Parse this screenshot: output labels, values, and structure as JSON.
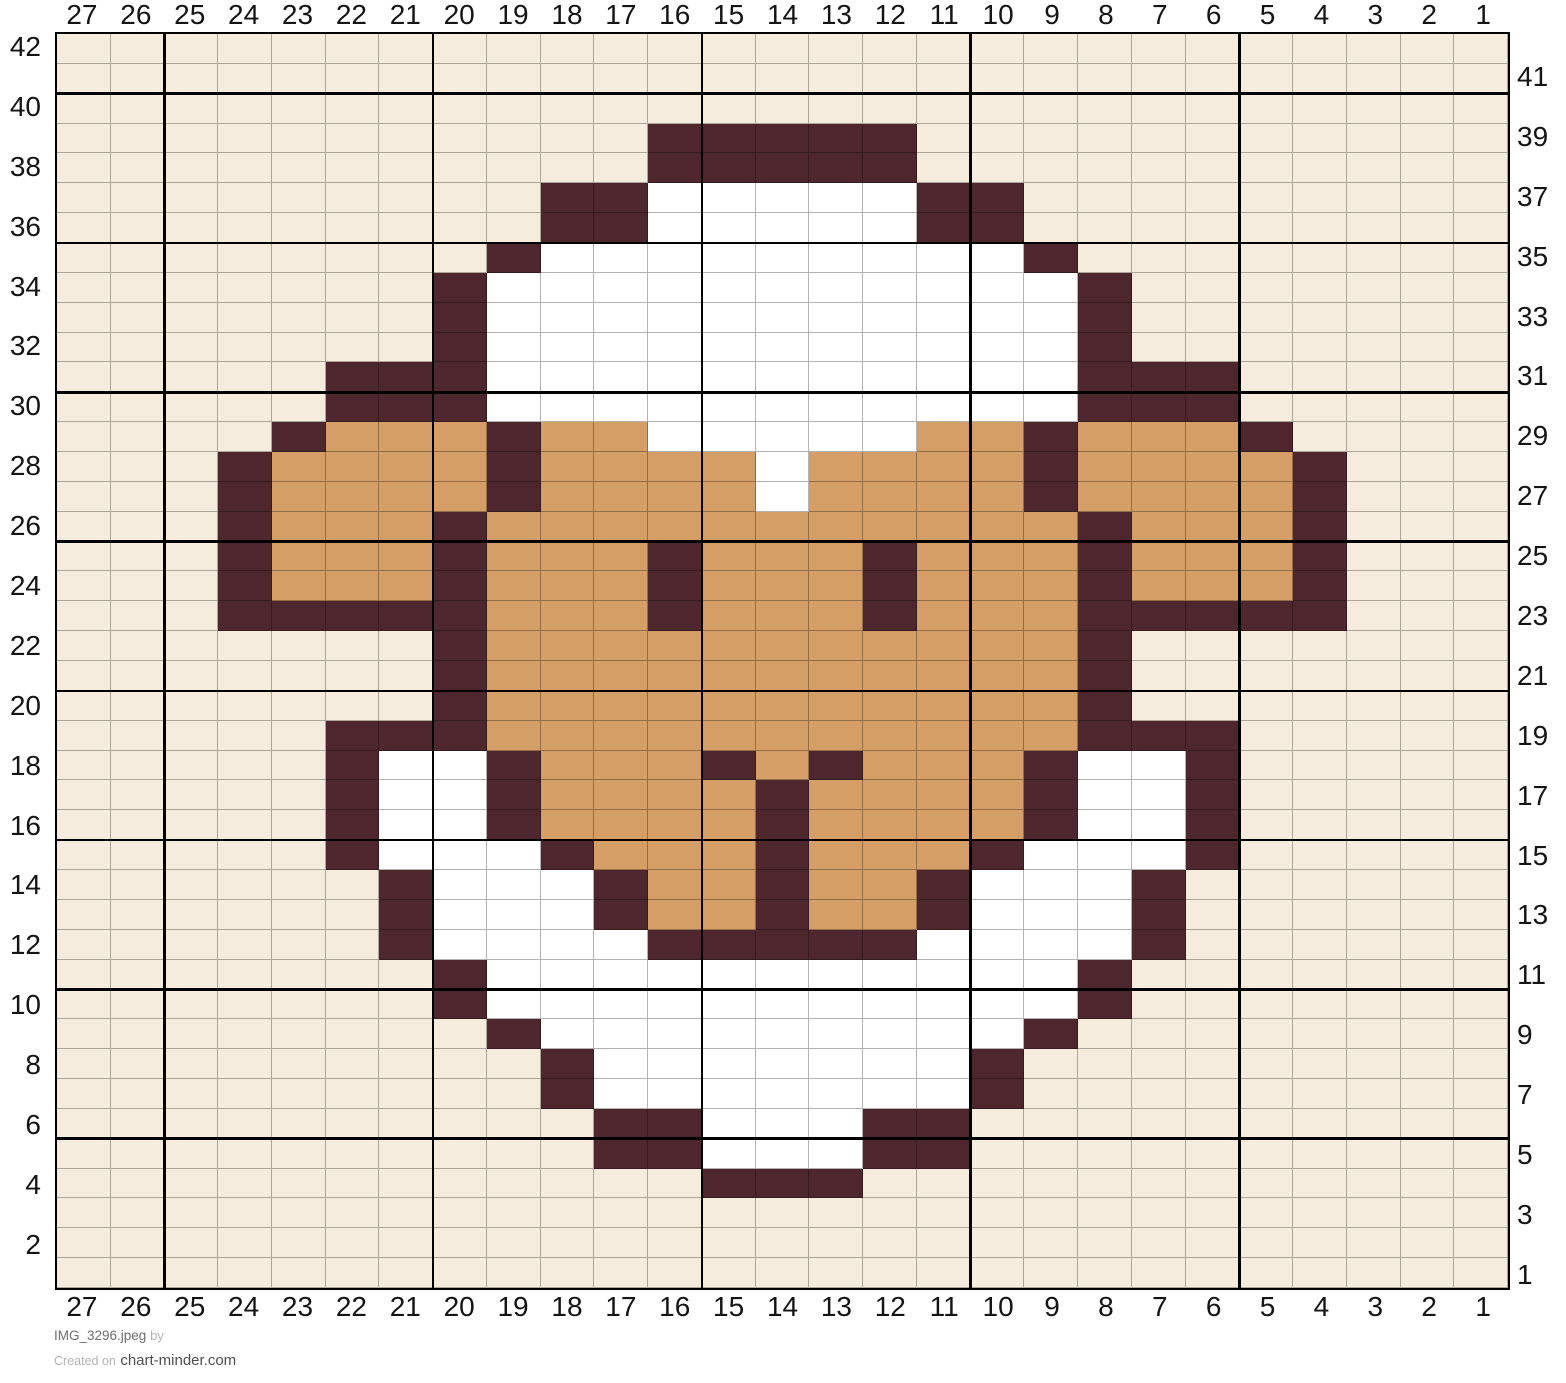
{
  "chart_data": {
    "type": "heatmap",
    "grid_cols": 27,
    "grid_rows": 42,
    "column_labels": [
      "27",
      "26",
      "25",
      "24",
      "23",
      "22",
      "21",
      "20",
      "19",
      "18",
      "17",
      "16",
      "15",
      "14",
      "13",
      "12",
      "11",
      "10",
      "9",
      "8",
      "7",
      "6",
      "5",
      "4",
      "3",
      "2",
      "1"
    ],
    "left_row_labels": [
      "42",
      "40",
      "38",
      "36",
      "34",
      "32",
      "30",
      "28",
      "26",
      "24",
      "22",
      "20",
      "18",
      "16",
      "14",
      "12",
      "10",
      "8",
      "6",
      "4",
      "2"
    ],
    "right_row_labels": [
      "41",
      "39",
      "37",
      "35",
      "33",
      "31",
      "29",
      "27",
      "25",
      "23",
      "21",
      "19",
      "17",
      "15",
      "13",
      "11",
      "9",
      "7",
      "5",
      "3",
      "1"
    ],
    "palette": {
      ".": "#f6ecdd",
      "W": "#ffffff",
      "T": "#d59e66",
      "D": "#4e262e"
    },
    "rows": [
      "...........................",
      "...........................",
      "...........................",
      "...........DDDDD...........",
      "...........DDDDD...........",
      ".........DDWWWWWDD.........",
      ".........DDWWWWWDD.........",
      "........DWWWWWWWWWD........",
      ".......DWWWWWWWWWWWD.......",
      ".......DWWWWWWWWWWWD.......",
      ".......DWWWWWWWWWWWD.......",
      ".....DDDWWWWWWWWWWWDDD.....",
      ".....DDDWWWWWWWWWWWDDD.....",
      "....DTTTDTTWWWWWTTDTTTD....",
      "...DTTTTDTTTTWTTTTDTTTTD...",
      "...DTTTTDTTTTWTTTTDTTTTD...",
      "...DTTTDTTTTTTTTTTTDTTTD...",
      "...DTTTDTTTDTTTDTTTDTTTD...",
      "...DTTTDTTTDTTTDTTTDTTTD...",
      "...DDDDDTTTDTTTDTTTDDDDD...",
      ".......DTTTTTTTTTTTD.......",
      ".......DTTTTTTTTTTTD.......",
      ".......DTTTTTTTTTTTD.......",
      ".....DDDTTTTTTTTTTTDDD.....",
      ".....DWWDTTTDTDTTTDWWD.....",
      ".....DWWDTTTTDTTTTDWWD.....",
      ".....DWWDTTTTDTTTTDWWD.....",
      ".....DWWWDTTTDTTTDWWWD.....",
      "......DWWWDTTDTTDWWWD......",
      "......DWWWDTTDTTDWWWD......",
      "......DWWWWDDDDDWWWWD......",
      ".......DWWWWWWWWWWWD.......",
      ".......DWWWWWWWWWWWD.......",
      "........DWWWWWWWWWD........",
      ".........DWWWWWWWD.........",
      ".........DWWWWWWWD.........",
      "..........DDWWWDD..........",
      "..........DDWWWDD..........",
      "............DDD............",
      "...........................",
      "...........................",
      "..........................."
    ],
    "bold_line_cols_from_left": [
      2,
      7,
      12,
      17,
      22
    ],
    "bold_line_rows_from_top": [
      2,
      7,
      12,
      17,
      22,
      27,
      32,
      37
    ],
    "thin_line_color": "rgba(0,0,0,0.30)",
    "bold_line_color": "#000000"
  },
  "footer": {
    "file_name": "IMG_3296.jpeg",
    "by_label": "by",
    "created_on": "Created on",
    "site": "chart-minder.com"
  }
}
